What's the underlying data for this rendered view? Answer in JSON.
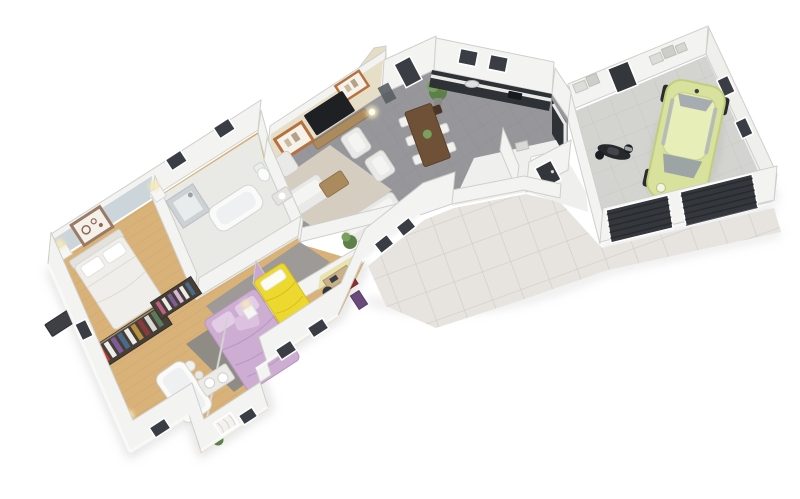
{
  "scene": {
    "type": "3d-floorplan-render",
    "description": "Isometric 3D render of a single-storey house plan: living/dining/kitchen wing, bedroom wing with three bedrooms and two bathrooms, tiled terrace walkway, and attached garage with a compact car and scooter.",
    "background": "#ffffff"
  },
  "palette": {
    "wall_white": "#f3f3f1",
    "wall_face": "#efefec",
    "wall_top": "#fbfbfa",
    "wall_shade": "#e2e2de",
    "accent_beige_wall": "#e7dec7",
    "accent_blue_wall": "#ccd5da",
    "accent_lilac_wall": "#c9a7d3",
    "accent_yellow_wall": "#e8e3b0",
    "tan_wall": "#e6ddc6",
    "floor_tile_dark": "#97979b",
    "floor_wood": "#d8b279",
    "floor_bath": "#e9e9e6",
    "floor_white": "#efefed",
    "floor_concrete": "#d3d3d0",
    "floor_terrace": "#e7e4df",
    "sofa_light": "#e9e9e7",
    "rug_beige": "#d8d1c2",
    "rug_grey": "#8f8c86",
    "rug_white": "#f4f3ef",
    "wood_furniture": "#ab8a5e",
    "table_dark": "#6e5137",
    "chair_dark": "#4a3526",
    "tv_black": "#1e2024",
    "frame_orange": "#b5713e",
    "kitchen_dark": "#2e3136",
    "counter_white": "#e9e9e7",
    "bed_white": "#efeeea",
    "bed_purple": "#cdaed2",
    "bed_purple_light": "#e3cce6",
    "bed_yellow": "#ecd82f",
    "bed_yellow_shade": "#d4bf1e",
    "car_body": "#d9e29c",
    "car_roof": "#e8eeb8",
    "car_window": "#9aa0a6",
    "car_edge": "#c2cd7e",
    "scooter_dark": "#26282c",
    "garage_door": "#34383d",
    "door_dark": "#33373c",
    "window_dark": "#3a3e44",
    "wardrobe_dark": "#473f37",
    "plant_green": "#5d8049",
    "plant_green_light": "#79a05e",
    "lamp_warm": "#f6e8b8",
    "fixture_white": "#fafaf9",
    "shower_tile": "#ccd1d3",
    "tub_inner": "#eef0f1",
    "red_box": "#8e2f2f",
    "purple_box": "#6a4a7a",
    "shadow": "#c2c2c2"
  },
  "rooms": [
    {
      "id": "living-room",
      "floor": "dark grey tile",
      "features": [
        "beige accent wall",
        "wall TV",
        "two orange-framed pictures",
        "corner sofa set",
        "beige rug"
      ]
    },
    {
      "id": "dining-area",
      "floor": "dark grey tile",
      "features": [
        "dark wood table",
        "six chairs",
        "potted plant"
      ]
    },
    {
      "id": "kitchen",
      "floor": "dark grey tile",
      "features": [
        "charcoal L-shaped cabinets",
        "two windows"
      ]
    },
    {
      "id": "entry-pantry",
      "floor": "white tile",
      "features": [
        "front door",
        "white appliance"
      ]
    },
    {
      "id": "hallway",
      "floor": "grey tile",
      "features": [
        "desk nook with office chair"
      ]
    },
    {
      "id": "master-bedroom",
      "floor": "wood",
      "features": [
        "white double bed",
        "pale blue wall",
        "framed plate picture",
        "open wardrobe"
      ]
    },
    {
      "id": "bathroom-main",
      "floor": "light tile",
      "features": [
        "tiled shower",
        "bathtub",
        "WC",
        "basin"
      ]
    },
    {
      "id": "bedroom-purple",
      "floor": "wood",
      "features": [
        "lavender bed",
        "grey rug",
        "lilac accent wall",
        "wardrobe"
      ]
    },
    {
      "id": "bedroom-yellow",
      "floor": "wood",
      "features": [
        "yellow bed",
        "desk",
        "toy plane",
        "white rug"
      ]
    },
    {
      "id": "bathroom-family",
      "floor": "wood",
      "features": [
        "bathtub",
        "double-basin vanity",
        "curtained window"
      ]
    },
    {
      "id": "storage-niche",
      "floor": "wood",
      "features": [
        "red bins",
        "purple cabinet"
      ]
    },
    {
      "id": "garage",
      "floor": "concrete",
      "features": [
        "pale green compact car",
        "black scooter",
        "two dark garage doors",
        "rear service door",
        "wall shelving",
        "two windows"
      ]
    },
    {
      "id": "terrace-driveway",
      "floor": "large light tiles",
      "features": []
    }
  ],
  "objects": [
    {
      "id": "car",
      "color_ref": "car_body"
    },
    {
      "id": "scooter",
      "color_ref": "scooter_dark"
    },
    {
      "id": "bed-master",
      "color_ref": "bed_white"
    },
    {
      "id": "bed-purple",
      "color_ref": "bed_purple"
    },
    {
      "id": "bed-yellow",
      "color_ref": "bed_yellow"
    },
    {
      "id": "tv",
      "color_ref": "tv_black"
    },
    {
      "id": "garage-doors",
      "count": 2,
      "color_ref": "garage_door"
    }
  ],
  "counts": {
    "windows_dark": 14,
    "picture_frames": 3,
    "sofas": 4,
    "garage_doors": 2
  }
}
